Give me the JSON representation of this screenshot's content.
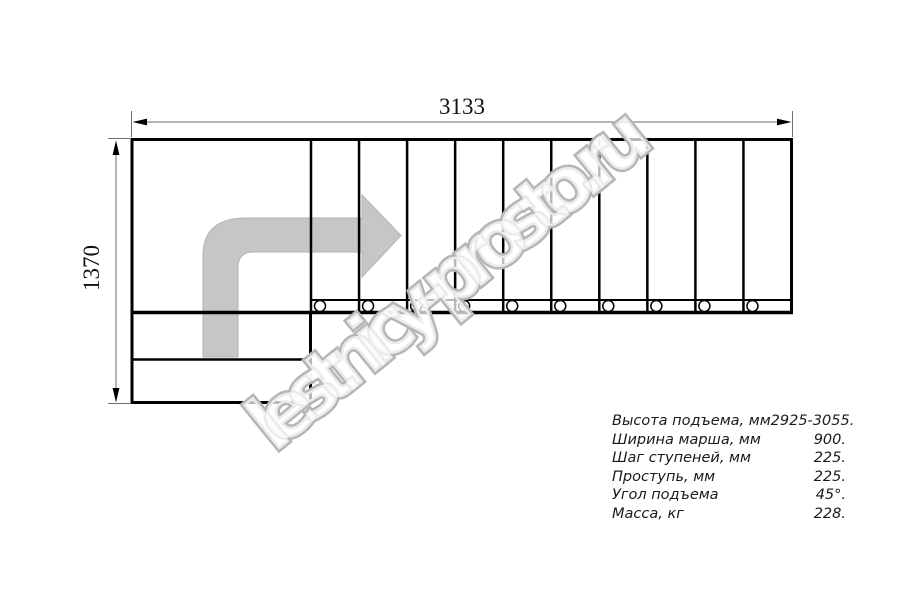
{
  "title": "Stair plan drawing (L-shaped staircase, top view)",
  "dimensions": {
    "width_label": "3133",
    "height_label": "1370"
  },
  "watermark": {
    "text": "lestnicy-prosto.ru"
  },
  "plan": {
    "straight_treads": 10,
    "balusters": 10,
    "winder_steps": 2,
    "direction_arrow_icon": "turn-right-arrow"
  },
  "specs": {
    "rows": [
      {
        "label": "Высота подъема, мм",
        "value": "2925-3055."
      },
      {
        "label": "Ширина марша, мм",
        "value": "900."
      },
      {
        "label": "Шаг ступеней, мм",
        "value": "225."
      },
      {
        "label": "Проступь, мм",
        "value": "225."
      },
      {
        "label": "Угол подъема",
        "value": "45°."
      },
      {
        "label": "Масса, кг",
        "value": "228."
      }
    ]
  },
  "colors": {
    "line": "#000000",
    "dim_line": "#6e6e6e",
    "arrow_fill": "#c6c6c6",
    "arrow_edge": "#b2b2b2",
    "watermark_stroke": "#b6b6b6"
  }
}
